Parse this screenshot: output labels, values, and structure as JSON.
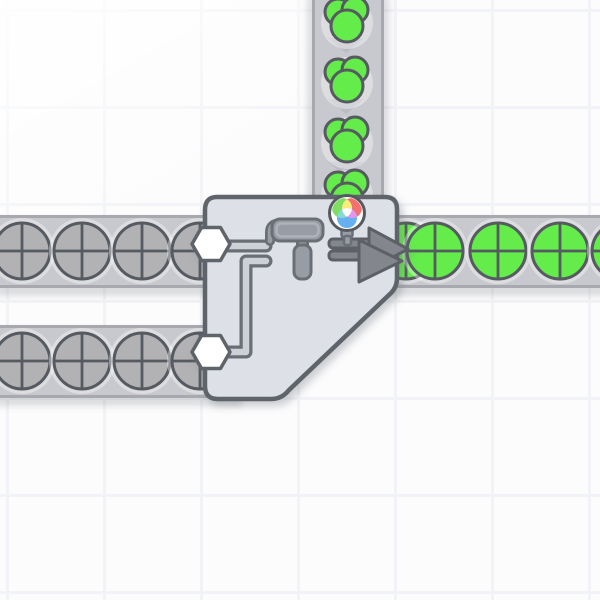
{
  "app": {
    "name": "shape-factory-game",
    "view": "factory-grid"
  },
  "canvas": {
    "w": 600,
    "h": 600,
    "bg": "#fcfcfd",
    "grid": {
      "spacing": 97,
      "line_width": 3,
      "offset_x": 6,
      "offset_y": 9,
      "color": "#f2f3f6"
    }
  },
  "palette": {
    "belt": "#c8c9ce",
    "belt_edge": "#a7a9af",
    "chevron": "#bbbcc2",
    "belt_shadow": "rgba(99,103,114,0.22)",
    "halo": "rgba(255,255,255,0.38)",
    "outline": "#565a61",
    "uncolored": "#b2b2b5",
    "green": "#64ec4b",
    "building_fill": "#dde0e7",
    "building_stroke": "#5f636b",
    "icon": "#989ca4",
    "icon_stroke": "#6b6e76",
    "icon_inner": "#aeb2ba",
    "pipe": "#ced0d8",
    "arrow": "#84868e",
    "arrow_stroke": "#5d6068",
    "port": "#ffffff",
    "wheel": {
      "ring": "#ffffff",
      "green": "#7fdd62",
      "red": "#f3706f",
      "blue": "#66b0f2",
      "yellow": "#f6ee79",
      "cyan": "#84ddd0",
      "magenta": "#e595eb",
      "center": "#fdfdfb"
    }
  },
  "belts": [
    {
      "id": "belt-vertical-color-input",
      "x": 312,
      "y": -6,
      "w": 72,
      "h": 206,
      "dir": "down",
      "chevrons": [
        {
          "x": 346,
          "y": 45
        },
        {
          "x": 346,
          "y": 106
        },
        {
          "x": 346,
          "y": 169
        }
      ]
    },
    {
      "id": "belt-left-upper-input",
      "x": -6,
      "y": 215,
      "w": 246,
      "h": 73,
      "dir": "right",
      "chevrons": [
        {
          "x": 52,
          "y": 251
        },
        {
          "x": 112,
          "y": 251
        },
        {
          "x": 172,
          "y": 251
        }
      ]
    },
    {
      "id": "belt-left-lower-input",
      "x": -6,
      "y": 325,
      "w": 246,
      "h": 73,
      "dir": "right",
      "chevrons": [
        {
          "x": 52,
          "y": 361
        },
        {
          "x": 112,
          "y": 361
        },
        {
          "x": 172,
          "y": 361
        }
      ]
    },
    {
      "id": "belt-right-output",
      "x": 360,
      "y": 215,
      "w": 246,
      "h": 73,
      "dir": "right",
      "chevrons": [
        {
          "x": 466,
          "y": 251
        },
        {
          "x": 529,
          "y": 251
        },
        {
          "x": 591,
          "y": 251
        }
      ]
    }
  ],
  "items": {
    "circle_radius": 28,
    "halo_radius": 33,
    "uncolored_circles": [
      [
        22,
        251
      ],
      [
        82,
        251
      ],
      [
        142,
        251
      ],
      [
        200,
        251
      ],
      [
        22,
        361
      ],
      [
        82,
        361
      ],
      [
        142,
        361
      ],
      [
        200,
        361
      ]
    ],
    "green_circles": [
      [
        406,
        251
      ],
      [
        435,
        251
      ],
      [
        498,
        251
      ],
      [
        560,
        251
      ],
      [
        620,
        251
      ]
    ],
    "green_color_blobs": [
      [
        347,
        23
      ],
      [
        347,
        83
      ],
      [
        347,
        143
      ],
      [
        347,
        196
      ]
    ]
  },
  "building": {
    "id": "painter-building",
    "kind": "double-painter",
    "body_path": "M 217 197 H 385 Q 397 197 397 209 V 278 Q 397 287 391 293 L 289 390 Q 282 399 271 399 H 218 Q 205 399 205 386 V 210 Q 205 197 217 197 Z",
    "ports": [
      {
        "cx": 211,
        "cy": 244
      },
      {
        "cx": 211,
        "cy": 352
      }
    ],
    "port_radius": 19,
    "pipes": [
      "M 228 246 H 266",
      "M 227 352 H 246 V 261 H 266"
    ],
    "roller": {
      "hook": "M 282 223 Q 270 223 270 232 L 270 241",
      "neck": {
        "x": 297.5,
        "y": 235,
        "w": 10,
        "h": 14
      },
      "handle": {
        "x": 294,
        "y": 245,
        "w": 17,
        "h": 34
      },
      "body": {
        "x": 272,
        "y": 219,
        "w": 51,
        "h": 22
      },
      "inner": {
        "x": 276.5,
        "y": 223.5,
        "w": 42,
        "h": 13
      }
    },
    "arrows": {
      "back": {
        "shaft": {
          "x": 329,
          "y": 239,
          "w": 42,
          "h": 9
        },
        "head": "369,228 408,249 369,270"
      },
      "front": {
        "shaft": {
          "x": 329,
          "y": 251,
          "w": 36,
          "h": 9
        },
        "head": "359,240 402,261 359,282"
      }
    },
    "wheel": {
      "cx": 347,
      "cy": 213,
      "r": 17.5,
      "sub_r": 10,
      "green_c": [
        342,
        208
      ],
      "red_c": [
        352,
        208
      ],
      "blue_c": [
        347,
        218
      ],
      "stem": [
        {
          "x": 341.5,
          "y": 228,
          "w": 11,
          "h": 9
        },
        {
          "x": 344,
          "y": 236,
          "w": 7,
          "h": 9
        }
      ]
    }
  }
}
